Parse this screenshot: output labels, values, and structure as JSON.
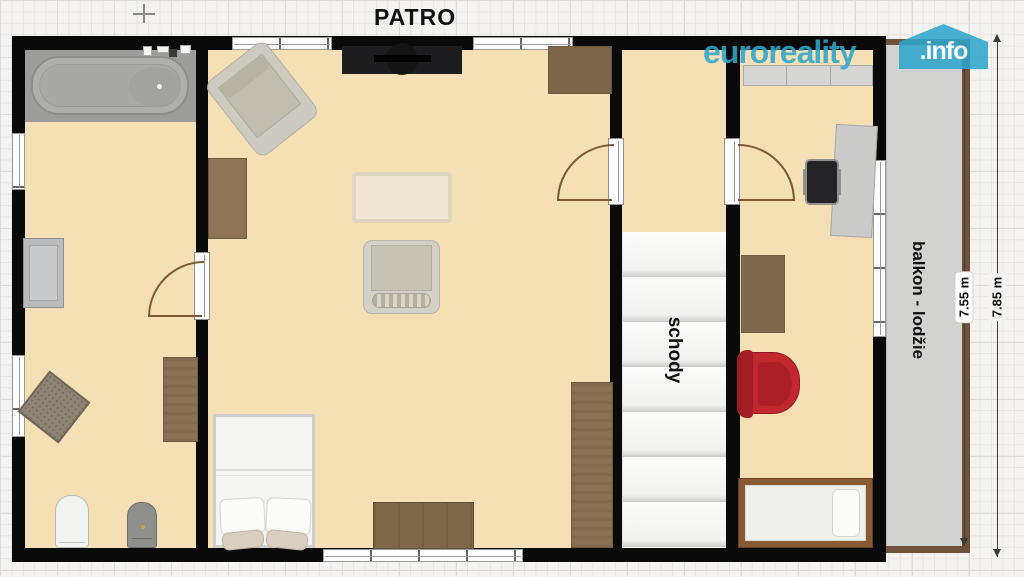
{
  "title": "PATRO",
  "brand": {
    "name": "euroreality",
    "tld": ".info"
  },
  "labels": {
    "stairs": "schody",
    "balcony": "balkon - lodžie"
  },
  "dimensions": [
    {
      "value": "7.55 m"
    },
    {
      "value": "7.85 m"
    }
  ],
  "colors": {
    "canvas_bg": "#f4f3f0",
    "grid_line": "#e7e5e0",
    "grid_major": "#dedcd6",
    "wall": "#0a0a0a",
    "floor": "#f5dfb4",
    "tile": "#9d9d9b",
    "stairs_bg": "#f9f9f8",
    "step_edge": "#d7d7d4",
    "balcony_floor": "#d2d2d0",
    "balcony_trim": "#6e5138",
    "wood": "#8a7154",
    "wood_dark": "#6f5a42",
    "brand_cyan": "#2fa6ca",
    "chair_red": "#c1272d",
    "window_frame": "#9a9a98",
    "dim_line": "#3a3a3a"
  },
  "rooms": [
    {
      "name": "bathroom",
      "furniture": [
        "bathtub",
        "sink",
        "toilet",
        "bidet",
        "rug",
        "cabinet"
      ]
    },
    {
      "name": "living-room",
      "furniture": [
        "tv-unit",
        "armchair",
        "doormat",
        "rug",
        "armchair",
        "double-bed",
        "bench",
        "wardrobe",
        "cabinet"
      ]
    },
    {
      "name": "staircase",
      "furniture": [
        "stairs"
      ]
    },
    {
      "name": "study-bedroom",
      "furniture": [
        "dresser",
        "desk",
        "office-chair",
        "shelf",
        "red-armchair",
        "single-bed"
      ]
    },
    {
      "name": "balcony",
      "furniture": []
    }
  ]
}
